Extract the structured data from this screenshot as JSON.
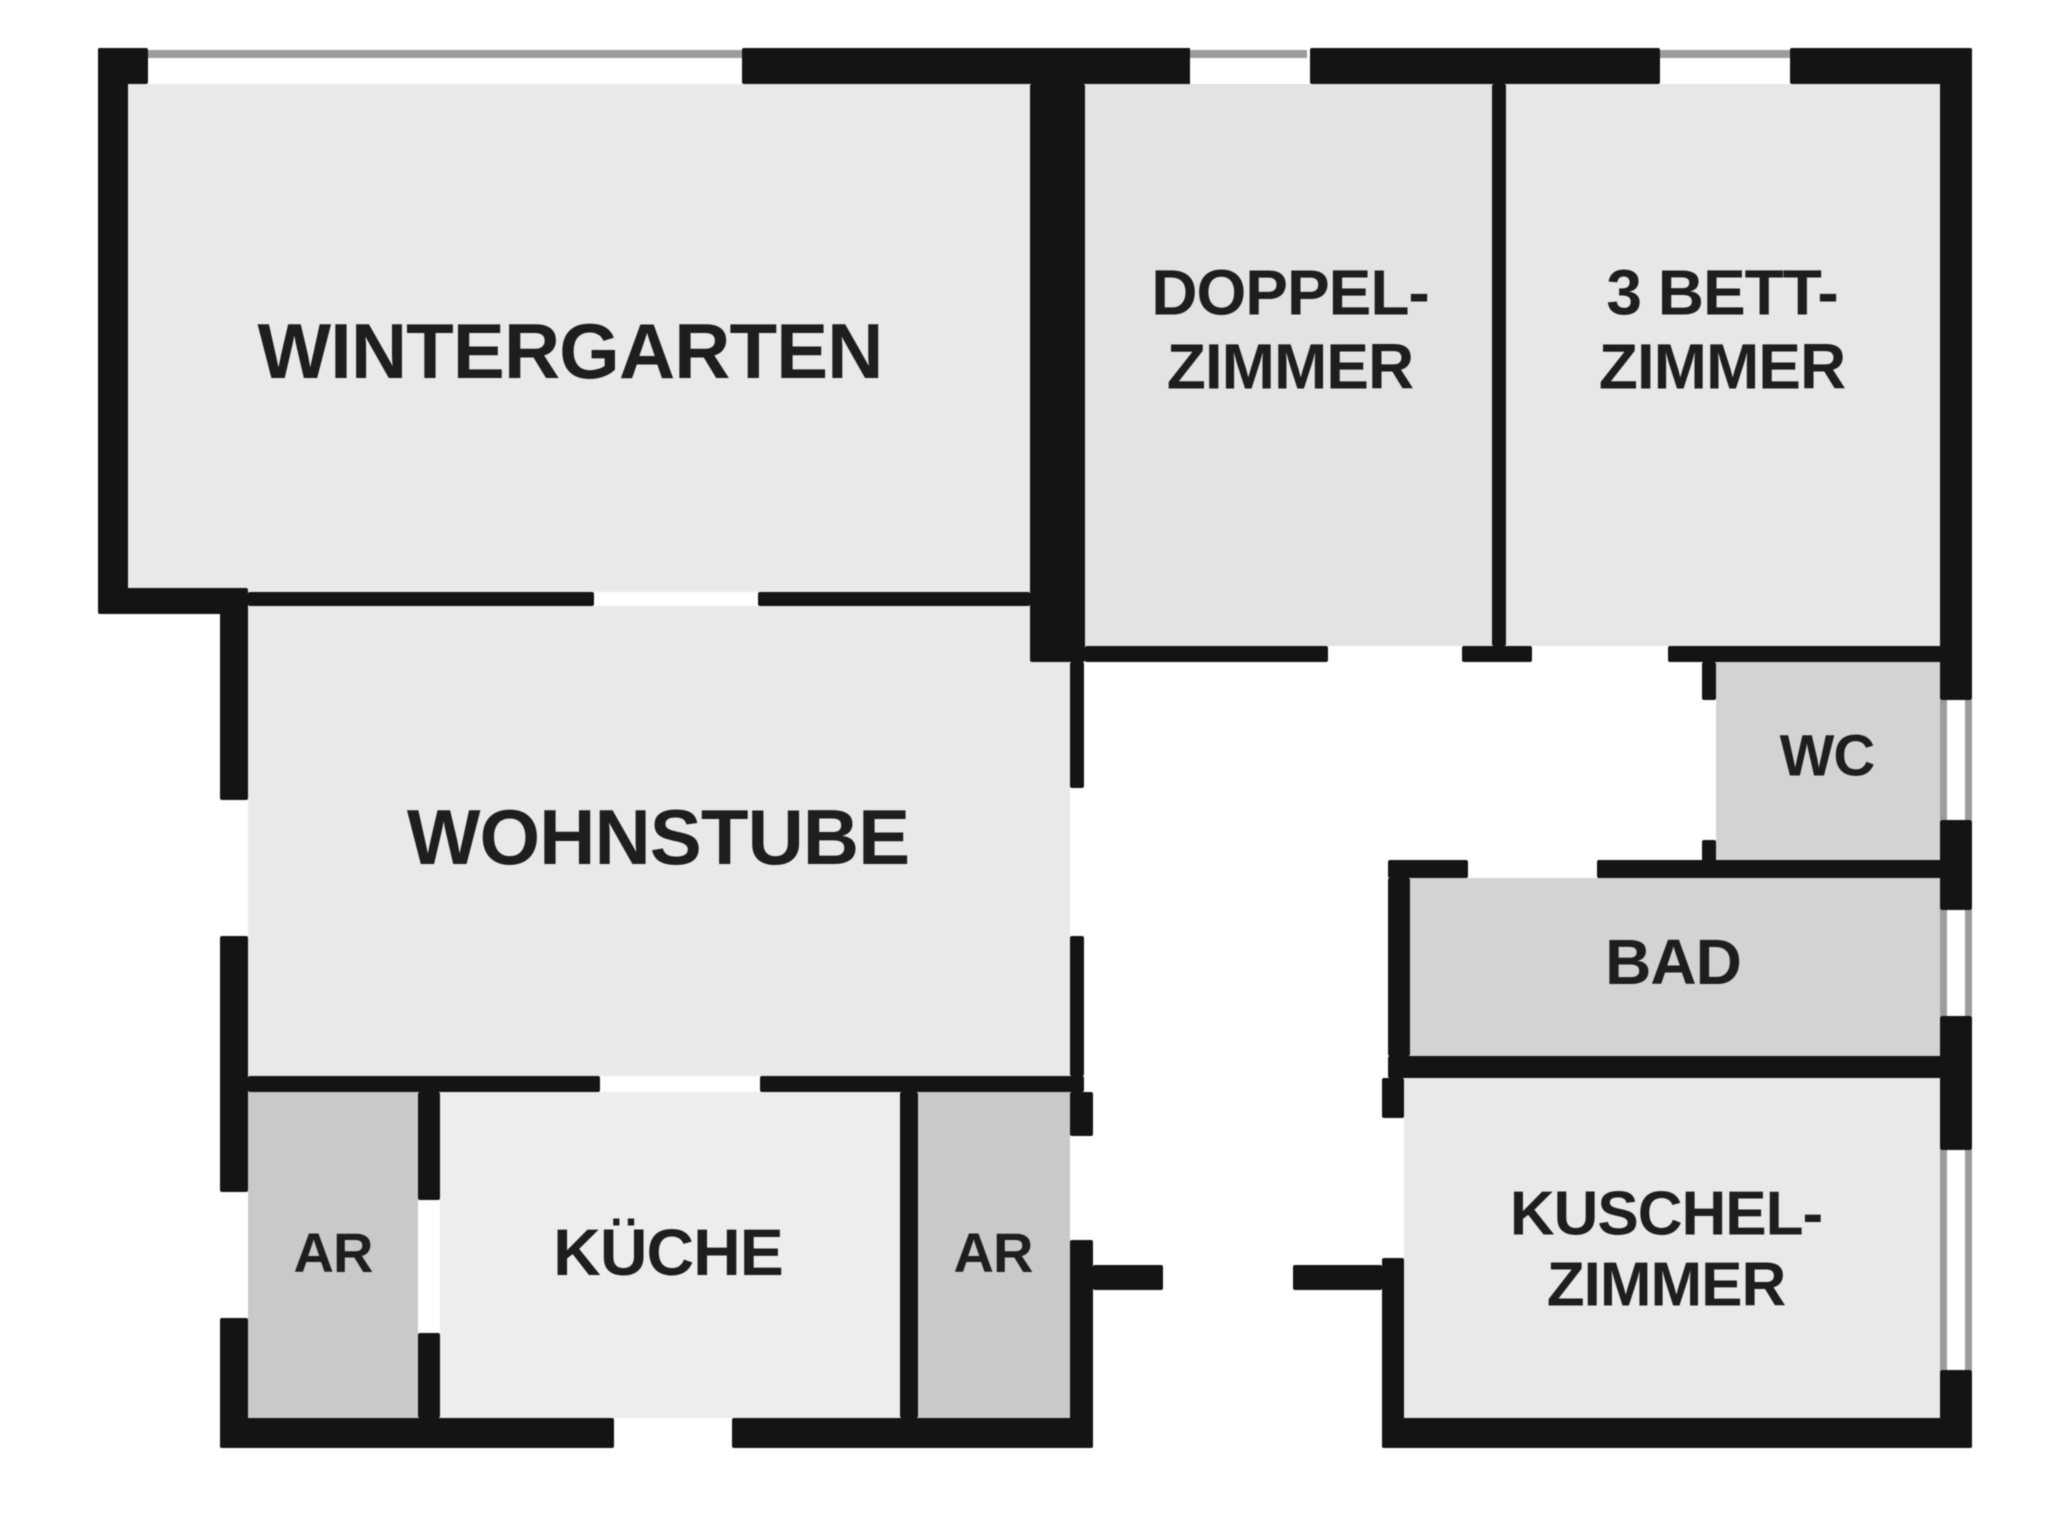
{
  "plan": {
    "canvas": {
      "width": 2048,
      "height": 1536
    },
    "background_color": "#ffffff",
    "wall_color": "#141414",
    "window_line_color": "#9c9c9c",
    "label_color": "#1e1e1e",
    "rooms": [
      {
        "id": "wintergarten",
        "label": "WINTERGARTEN",
        "x": 128,
        "y": 84,
        "w": 902,
        "h": 508,
        "fill": "#e9e9e9",
        "label_cx": 570,
        "label_cy": 352,
        "font_size": 78
      },
      {
        "id": "doppelzimmer",
        "label": "DOPPEL-\nZIMMER",
        "x": 1085,
        "y": 84,
        "w": 407,
        "h": 562,
        "fill": "#e3e3e3",
        "label_cx": 1290,
        "label_cy": 330,
        "font_size": 64
      },
      {
        "id": "dreibettzimmer",
        "label": "3 BETT-\nZIMMER",
        "x": 1506,
        "y": 84,
        "w": 434,
        "h": 562,
        "fill": "#e7e7e7",
        "label_cx": 1722,
        "label_cy": 330,
        "font_size": 64
      },
      {
        "id": "wohnstube",
        "label": "WOHNSTUBE",
        "x": 248,
        "y": 606,
        "w": 822,
        "h": 470,
        "fill": "#e9e9e9",
        "label_cx": 658,
        "label_cy": 838,
        "font_size": 78
      },
      {
        "id": "kueche",
        "label": "KÜCHE",
        "x": 440,
        "y": 1092,
        "w": 460,
        "h": 326,
        "fill": "#ededed",
        "label_cx": 668,
        "label_cy": 1253,
        "font_size": 66
      },
      {
        "id": "ar-links",
        "label": "AR",
        "x": 248,
        "y": 1092,
        "w": 170,
        "h": 326,
        "fill": "#c9c9c9",
        "label_cx": 333,
        "label_cy": 1253,
        "font_size": 56
      },
      {
        "id": "ar-rechts",
        "label": "AR",
        "x": 918,
        "y": 1092,
        "w": 152,
        "h": 326,
        "fill": "#c9c9c9",
        "label_cx": 993,
        "label_cy": 1253,
        "font_size": 56
      },
      {
        "id": "wc",
        "label": "WC",
        "x": 1716,
        "y": 662,
        "w": 224,
        "h": 198,
        "fill": "#d3d3d3",
        "label_cx": 1827,
        "label_cy": 757,
        "font_size": 58
      },
      {
        "id": "bad",
        "label": "BAD",
        "x": 1410,
        "y": 878,
        "w": 530,
        "h": 178,
        "fill": "#d3d3d3",
        "label_cx": 1673,
        "label_cy": 963,
        "font_size": 64
      },
      {
        "id": "kuschelzimmer",
        "label": "KUSCHEL-\nZIMMER",
        "x": 1404,
        "y": 1078,
        "w": 536,
        "h": 340,
        "fill": "#e9e9e9",
        "label_cx": 1666,
        "label_cy": 1250,
        "font_size": 62
      }
    ],
    "walls": [
      {
        "x": 98,
        "y": 48,
        "w": 50,
        "h": 36
      },
      {
        "x": 742,
        "y": 48,
        "w": 453,
        "h": 36
      },
      {
        "x": 1310,
        "y": 48,
        "w": 350,
        "h": 36
      },
      {
        "x": 1790,
        "y": 48,
        "w": 182,
        "h": 36
      },
      {
        "x": 98,
        "y": 48,
        "w": 30,
        "h": 544
      },
      {
        "x": 98,
        "y": 588,
        "w": 150,
        "h": 26
      },
      {
        "x": 248,
        "y": 592,
        "w": 346,
        "h": 14
      },
      {
        "x": 758,
        "y": 592,
        "w": 272,
        "h": 14
      },
      {
        "x": 1030,
        "y": 84,
        "w": 55,
        "h": 578
      },
      {
        "x": 1492,
        "y": 84,
        "w": 14,
        "h": 562
      },
      {
        "x": 1085,
        "y": 646,
        "w": 243,
        "h": 16
      },
      {
        "x": 1462,
        "y": 646,
        "w": 70,
        "h": 16
      },
      {
        "x": 1668,
        "y": 646,
        "w": 304,
        "h": 16
      },
      {
        "x": 1070,
        "y": 662,
        "w": 14,
        "h": 126
      },
      {
        "x": 1070,
        "y": 936,
        "w": 14,
        "h": 140
      },
      {
        "x": 248,
        "y": 1076,
        "w": 352,
        "h": 16
      },
      {
        "x": 760,
        "y": 1076,
        "w": 324,
        "h": 16
      },
      {
        "x": 220,
        "y": 604,
        "w": 28,
        "h": 196
      },
      {
        "x": 220,
        "y": 936,
        "w": 28,
        "h": 256
      },
      {
        "x": 220,
        "y": 1318,
        "w": 28,
        "h": 130
      },
      {
        "x": 418,
        "y": 1092,
        "w": 22,
        "h": 108
      },
      {
        "x": 418,
        "y": 1333,
        "w": 22,
        "h": 85
      },
      {
        "x": 900,
        "y": 1092,
        "w": 18,
        "h": 326
      },
      {
        "x": 1070,
        "y": 1092,
        "w": 23,
        "h": 44
      },
      {
        "x": 1070,
        "y": 1240,
        "w": 23,
        "h": 208
      },
      {
        "x": 220,
        "y": 1418,
        "w": 394,
        "h": 30
      },
      {
        "x": 732,
        "y": 1418,
        "w": 361,
        "h": 30
      },
      {
        "x": 1093,
        "y": 1265,
        "w": 70,
        "h": 25
      },
      {
        "x": 1293,
        "y": 1265,
        "w": 89,
        "h": 25
      },
      {
        "x": 1382,
        "y": 1078,
        "w": 22,
        "h": 40
      },
      {
        "x": 1382,
        "y": 1258,
        "w": 22,
        "h": 190
      },
      {
        "x": 1702,
        "y": 662,
        "w": 14,
        "h": 38
      },
      {
        "x": 1702,
        "y": 840,
        "w": 14,
        "h": 38
      },
      {
        "x": 1388,
        "y": 860,
        "w": 80,
        "h": 18
      },
      {
        "x": 1597,
        "y": 860,
        "w": 375,
        "h": 18
      },
      {
        "x": 1388,
        "y": 878,
        "w": 22,
        "h": 178
      },
      {
        "x": 1388,
        "y": 1056,
        "w": 584,
        "h": 22
      },
      {
        "x": 1940,
        "y": 48,
        "w": 32,
        "h": 652
      },
      {
        "x": 1940,
        "y": 820,
        "w": 32,
        "h": 90
      },
      {
        "x": 1940,
        "y": 1016,
        "w": 32,
        "h": 134
      },
      {
        "x": 1940,
        "y": 1370,
        "w": 32,
        "h": 78
      },
      {
        "x": 1382,
        "y": 1418,
        "w": 590,
        "h": 30
      }
    ],
    "windows": [
      {
        "x": 148,
        "y": 48,
        "w": 594,
        "h": 36,
        "lines": [
          "top"
        ]
      },
      {
        "x": 1190,
        "y": 48,
        "w": 117,
        "h": 36,
        "lines": [
          "top"
        ]
      },
      {
        "x": 1660,
        "y": 48,
        "w": 130,
        "h": 36,
        "lines": [
          "top"
        ]
      },
      {
        "x": 220,
        "y": 800,
        "w": 28,
        "h": 136,
        "lines": []
      },
      {
        "x": 220,
        "y": 1192,
        "w": 28,
        "h": 126,
        "lines": []
      },
      {
        "x": 614,
        "y": 1418,
        "w": 118,
        "h": 30,
        "lines": []
      },
      {
        "x": 1940,
        "y": 700,
        "w": 32,
        "h": 120,
        "lines": [
          "left",
          "right"
        ]
      },
      {
        "x": 1940,
        "y": 910,
        "w": 32,
        "h": 106,
        "lines": [
          "left",
          "right"
        ]
      },
      {
        "x": 1940,
        "y": 1150,
        "w": 32,
        "h": 220,
        "lines": [
          "left",
          "right"
        ]
      }
    ]
  }
}
